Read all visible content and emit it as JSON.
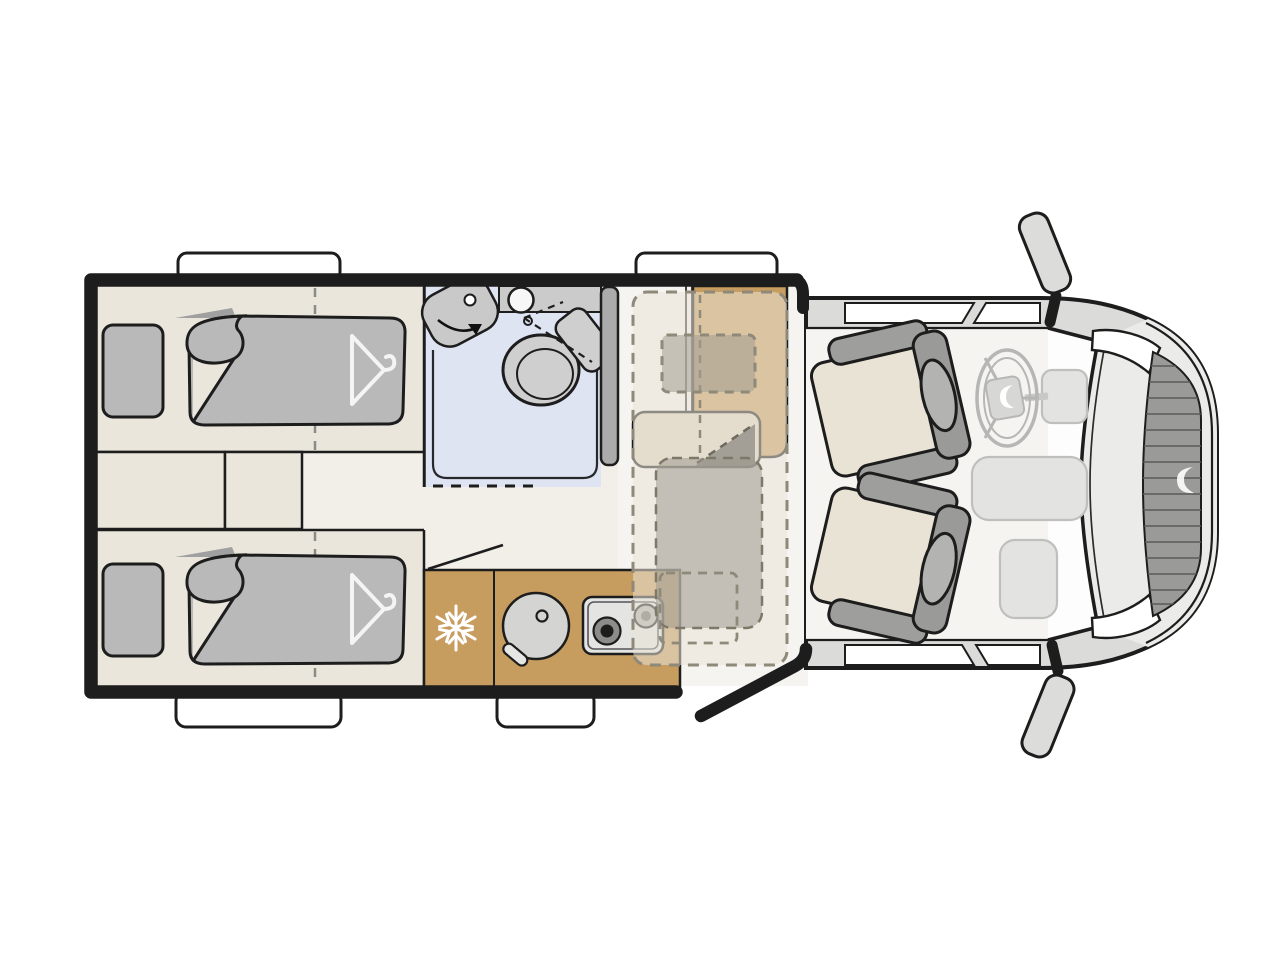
{
  "page": {
    "title": "Camper van floor plan - top view",
    "background": "#ffffff"
  },
  "colors": {
    "wall": "#1d1d1d",
    "floor_bed_area": "#eae6db",
    "floor_aisle": "#f1efe8",
    "floor_front": "#f5f4f1",
    "bedding_gray": "#b9b9b9",
    "bathroom_floor": "#dfe4f2",
    "fixture_gray": "#cbcbcb",
    "partition_gray": "#ababab",
    "kitchen_counter": "#c79c5f",
    "dinette_table": "#c89d61",
    "bench_cushion": "#ded5c0",
    "overlay_beige": "rgba(234,228,215,0.55)",
    "overlay_gray": "rgba(158,154,146,0.55)",
    "body_gray": "#dbdbd9",
    "hood_gray": "#ebebe9",
    "grille_gray": "#9a9a98",
    "seat_cushion": "#e8e3d5",
    "seat_frame": "#9e9e9c",
    "window_white": "#ffffff"
  },
  "areas": {
    "rear_bedroom": {
      "name": "Rear bedroom with two single beds",
      "bed_count": 2,
      "features": [
        "pillow",
        "duvet with folded corner",
        "wardrobe hanger symbol",
        "bed mid-line (dashed)",
        "two storage steps between beds"
      ]
    },
    "bathroom": {
      "name": "Bathroom / shower room",
      "features": [
        "shower tray (blue floor)",
        "swivel washbasin with rotation arrow",
        "toilet with dashed swivel lines",
        "counter with round basin",
        "dashed door line"
      ]
    },
    "kitchen": {
      "name": "Kitchenette",
      "features": [
        "fridge with snowflake symbol",
        "round sink with tap lever",
        "two-burner hob",
        "entry door swing line"
      ]
    },
    "dinette": {
      "name": "Half dinette with table",
      "features": [
        "table (tan)",
        "bench seat",
        "dashed bed-conversion outline",
        "dashed pillow outline",
        "translucent duvet overlay",
        "tall cabinet partition"
      ]
    },
    "cab": {
      "name": "Driver cab",
      "features": [
        "two swivel captain seats",
        "ghosted steering wheel with brand logo",
        "ghosted dashboard",
        "windshield",
        "side windows",
        "exterior mirrors",
        "open sliding door (black bar)",
        "hood",
        "headlights",
        "grille with brand logo",
        "entry step outside"
      ]
    }
  },
  "icons": [
    "snowflake-icon",
    "hanger-icon",
    "swivel-arrow-icon",
    "steering-wheel-icon",
    "brand-swoosh-logo"
  ]
}
